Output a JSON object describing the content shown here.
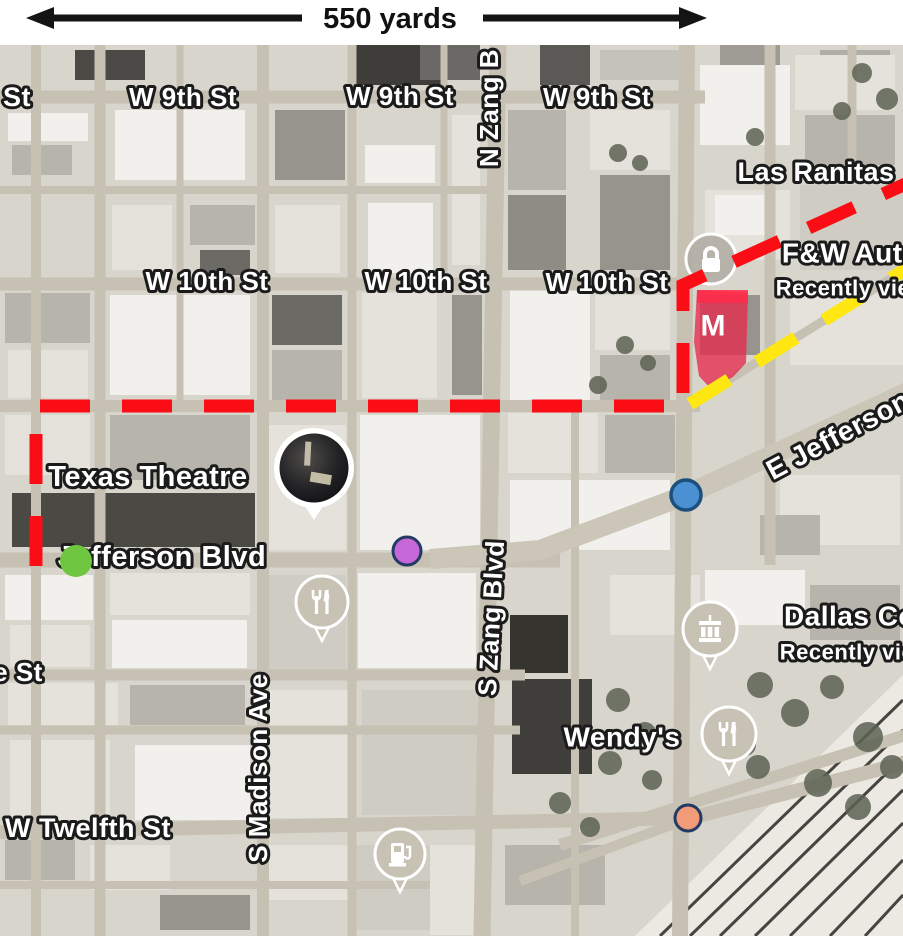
{
  "scale_bar": {
    "label": "550 yards"
  },
  "map": {
    "labels": [
      {
        "name": "street-label-st-fragment-top",
        "text": "St",
        "x": 17,
        "y": 52,
        "size": 27,
        "poi": false
      },
      {
        "name": "street-label-w9th-1",
        "text": "W 9th St",
        "x": 183,
        "y": 52,
        "size": 26,
        "poi": false
      },
      {
        "name": "street-label-w9th-2",
        "text": "W 9th St",
        "x": 400,
        "y": 51,
        "size": 26,
        "poi": false
      },
      {
        "name": "street-label-w9th-3",
        "text": "W 9th St",
        "x": 597,
        "y": 52,
        "size": 26,
        "poi": false
      },
      {
        "name": "street-label-n-zang",
        "text": "N Zang B",
        "x": 489,
        "y": 63,
        "size": 26,
        "rot": -90,
        "poi": false
      },
      {
        "name": "street-label-w10th-1",
        "text": "W 10th St",
        "x": 207,
        "y": 236,
        "size": 26,
        "poi": false
      },
      {
        "name": "street-label-w10th-2",
        "text": "W 10th St",
        "x": 426,
        "y": 236,
        "size": 26,
        "poi": false
      },
      {
        "name": "street-label-w10th-3",
        "text": "W 10th St",
        "x": 607,
        "y": 237,
        "size": 26,
        "poi": false
      },
      {
        "name": "poi-label-las-ranitas",
        "text": "Las Ranitas",
        "x": 816,
        "y": 127,
        "size": 27,
        "poi": true
      },
      {
        "name": "poi-label-fw-auto",
        "text": "F&W Auto",
        "x": 851,
        "y": 208,
        "size": 28,
        "poi": true
      },
      {
        "name": "poi-sublabel-recently-viewed-1",
        "text": "Recently vie",
        "x": 843,
        "y": 243,
        "size": 22,
        "poi": true
      },
      {
        "name": "street-label-e-jefferson",
        "text": "E Jefferson",
        "x": 838,
        "y": 390,
        "size": 28,
        "rot": -28,
        "poi": false
      },
      {
        "name": "poi-label-texas-theatre",
        "text": "Texas Theatre",
        "x": 148,
        "y": 432,
        "size": 29,
        "poi": true
      },
      {
        "name": "street-label-jefferson-blvd",
        "text": "Jefferson Blvd",
        "x": 162,
        "y": 512,
        "size": 29,
        "poi": false
      },
      {
        "name": "street-label-s-zang",
        "text": "S Zang Blvd",
        "x": 491,
        "y": 573,
        "size": 26,
        "rot": -87,
        "poi": false
      },
      {
        "name": "street-label-e-st-fragment",
        "text": "e St",
        "x": 18,
        "y": 627,
        "size": 26,
        "poi": false
      },
      {
        "name": "street-label-s-madison",
        "text": "S Madison Ave",
        "x": 258,
        "y": 723,
        "size": 26,
        "rot": -90,
        "poi": false
      },
      {
        "name": "poi-label-dallas-co",
        "text": "Dallas Co",
        "x": 850,
        "y": 571,
        "size": 28,
        "poi": true
      },
      {
        "name": "poi-sublabel-recently-viewed-2",
        "text": "Recently vie",
        "x": 847,
        "y": 607,
        "size": 22,
        "poi": true
      },
      {
        "name": "poi-label-wendys",
        "text": "Wendy's",
        "x": 622,
        "y": 692,
        "size": 28,
        "poi": true
      },
      {
        "name": "street-label-w-twelfth",
        "text": "W Twelfth St",
        "x": 88,
        "y": 783,
        "size": 27,
        "poi": false
      }
    ],
    "markers": [
      {
        "name": "texas-theatre-marker",
        "type": "photo",
        "x": 314,
        "y": 423,
        "r": 40
      },
      {
        "name": "lock-marker",
        "type": "lock",
        "x": 711,
        "y": 214,
        "r": 25
      },
      {
        "name": "restaurant-marker-jefferson",
        "type": "restaurant",
        "x": 322,
        "y": 557,
        "r": 26
      },
      {
        "name": "dallas-county-marker",
        "type": "museum",
        "x": 710,
        "y": 584,
        "r": 27
      },
      {
        "name": "restaurant-marker-wendys",
        "type": "restaurant",
        "x": 729,
        "y": 689,
        "r": 27
      },
      {
        "name": "fuel-station-marker",
        "type": "fuel",
        "x": 400,
        "y": 809,
        "r": 25
      }
    ],
    "dots": [
      {
        "name": "green-dot",
        "x": 76,
        "y": 516,
        "r": 16,
        "fill": "#6fc640",
        "stroke": "none",
        "sw": 0
      },
      {
        "name": "magenta-dot",
        "x": 407,
        "y": 506,
        "r": 14,
        "fill": "#c668d8",
        "stroke": "#243a64",
        "sw": 3
      },
      {
        "name": "blue-dot",
        "x": 686,
        "y": 450,
        "r": 15,
        "fill": "#4a90d2",
        "stroke": "#1d4f7c",
        "sw": 3.5
      },
      {
        "name": "salmon-dot",
        "x": 688,
        "y": 773,
        "r": 13,
        "fill": "#f29b79",
        "stroke": "#243a64",
        "sw": 3
      }
    ],
    "m_marker": {
      "label": "M",
      "fill": "#e62a4d",
      "opacity": 0.78,
      "points": "697,245 748,247 746,318 733,332 711,344 699,331 694,297",
      "label_x": 713,
      "label_y": 281
    },
    "annotations": {
      "red_dashed_route": {
        "color": "#fb0d15",
        "width": 13,
        "dash": "50 32",
        "points": "36,521 36,361 683,361 683,240 912,136"
      },
      "yellow_dashed_route": {
        "color": "#ffe712",
        "width": 13,
        "dash": "46 33",
        "points": "690,359 906,224"
      }
    }
  }
}
